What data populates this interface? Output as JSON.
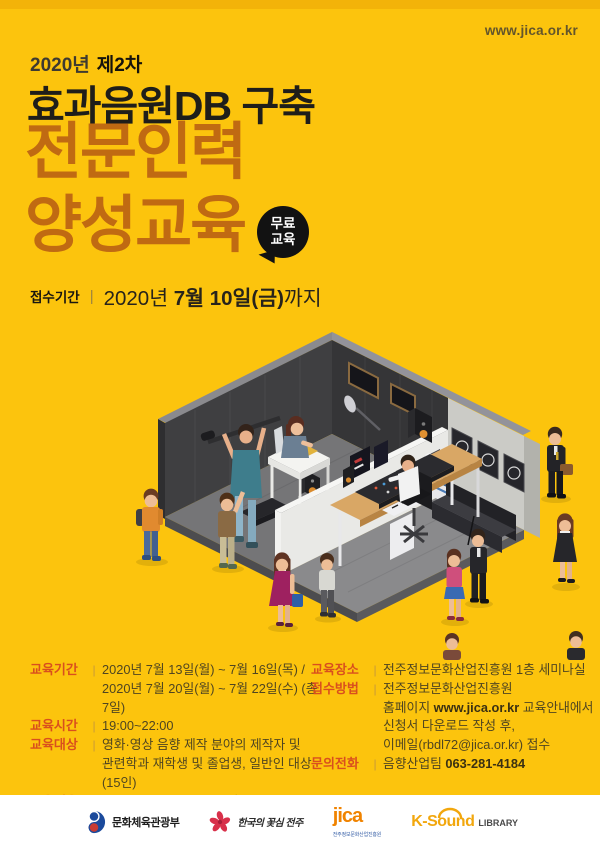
{
  "site_url": "www.jica.or.kr",
  "header": {
    "year": "2020년",
    "round": "제2차",
    "subtitle": "효과음원DB 구축",
    "title_line1": "전문인력",
    "title_line2": "양성교육",
    "badge_line1": "무료",
    "badge_line2": "교육",
    "deadline": {
      "label": "접수기간",
      "divider": "|",
      "segments": [
        {
          "t": "2020년 "
        },
        {
          "t": "7월 10일(금)",
          "b": true
        },
        {
          "t": "까지"
        }
      ]
    }
  },
  "info": {
    "left": [
      {
        "label": "교육기간",
        "lines": [
          [
            {
              "t": "2020년 7월 13일(월) ~ 7월 16일(목) /"
            }
          ],
          [
            {
              "t": "2020년 7월 20일(월) ~ 7월 22일(수) (총7일)"
            }
          ]
        ]
      },
      {
        "label": "교육시간",
        "lines": [
          [
            {
              "t": "19:00~22:00"
            }
          ]
        ]
      },
      {
        "label": "교육대상",
        "lines": [
          [
            {
              "t": "영화·영상 음향 제작 분야의 제작자 및"
            }
          ],
          [
            {
              "t": "관련학과 재학생 및 졸업생, 일반인 대상 (15인)"
            }
          ]
        ]
      },
      {
        "label": "교육내용",
        "lines": [
          [
            {
              "t": "한국형 영화 효과음원 구축을 위한 녹음, 편집기법"
            }
          ]
        ]
      }
    ],
    "right": [
      {
        "label": "교육장소",
        "lines": [
          [
            {
              "t": "전주정보문화산업진흥원 1층 세미나실"
            }
          ]
        ]
      },
      {
        "label": "접수방법",
        "lines": [
          [
            {
              "t": "전주정보문화산업진흥원"
            }
          ],
          [
            {
              "t": "홈페이지 "
            },
            {
              "t": "www.jica.or.kr",
              "b": true
            },
            {
              "t": " 교육안내에서"
            }
          ],
          [
            {
              "t": "신청서 다운로드 작성 후,"
            }
          ],
          [
            {
              "t": "이메일(rbdl72@jica.or.kr) 접수"
            }
          ]
        ]
      },
      {
        "label": "문의전화",
        "lines": [
          [
            {
              "t": "음향산업팀 "
            },
            {
              "t": "063-281-4184",
              "b": true
            }
          ]
        ]
      }
    ]
  },
  "footer": {
    "logo_mcst": "문화체육관광부",
    "logo_jeonju": "한국의 꽃심 전주",
    "logo_jica": "jica",
    "logo_jica_sub": "전주정보문화산업진흥원",
    "logo_ksound": "K-Sound",
    "logo_ksound_suffix": "LIBRARY"
  },
  "colors": {
    "background": "#FCC40D",
    "top_strip": "#F3B309",
    "headline": "#C06A12",
    "subtitle_text": "#1F1E1A",
    "badge_bg": "#121212",
    "info_label": "#D94F1E",
    "info_text": "#4F4521",
    "footer_bg": "#FFFFFF"
  }
}
